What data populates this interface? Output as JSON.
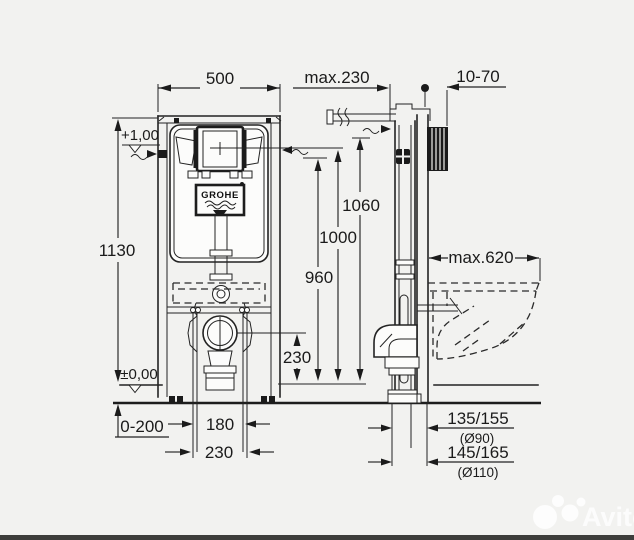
{
  "drawing": {
    "brand": "GROHE",
    "watermark": "Avito",
    "dims": {
      "width_front": "500",
      "height_frame": "1130",
      "meter_mark": "+1,00",
      "floor_level": "±0,00",
      "floor_range": "0-200",
      "stud_180": "180",
      "stud_230": "230",
      "wall_offset": "max.230",
      "sleeve_depth": "10-70",
      "h_1060": "1060",
      "h_1000": "1000",
      "h_960": "960",
      "drain_height": "230",
      "bowl_depth": "max.620",
      "drain_offset_90": "135/155",
      "drain_dia_90": "(Ø90)",
      "drain_offset_110": "145/165",
      "drain_dia_110": "(Ø110)"
    }
  }
}
